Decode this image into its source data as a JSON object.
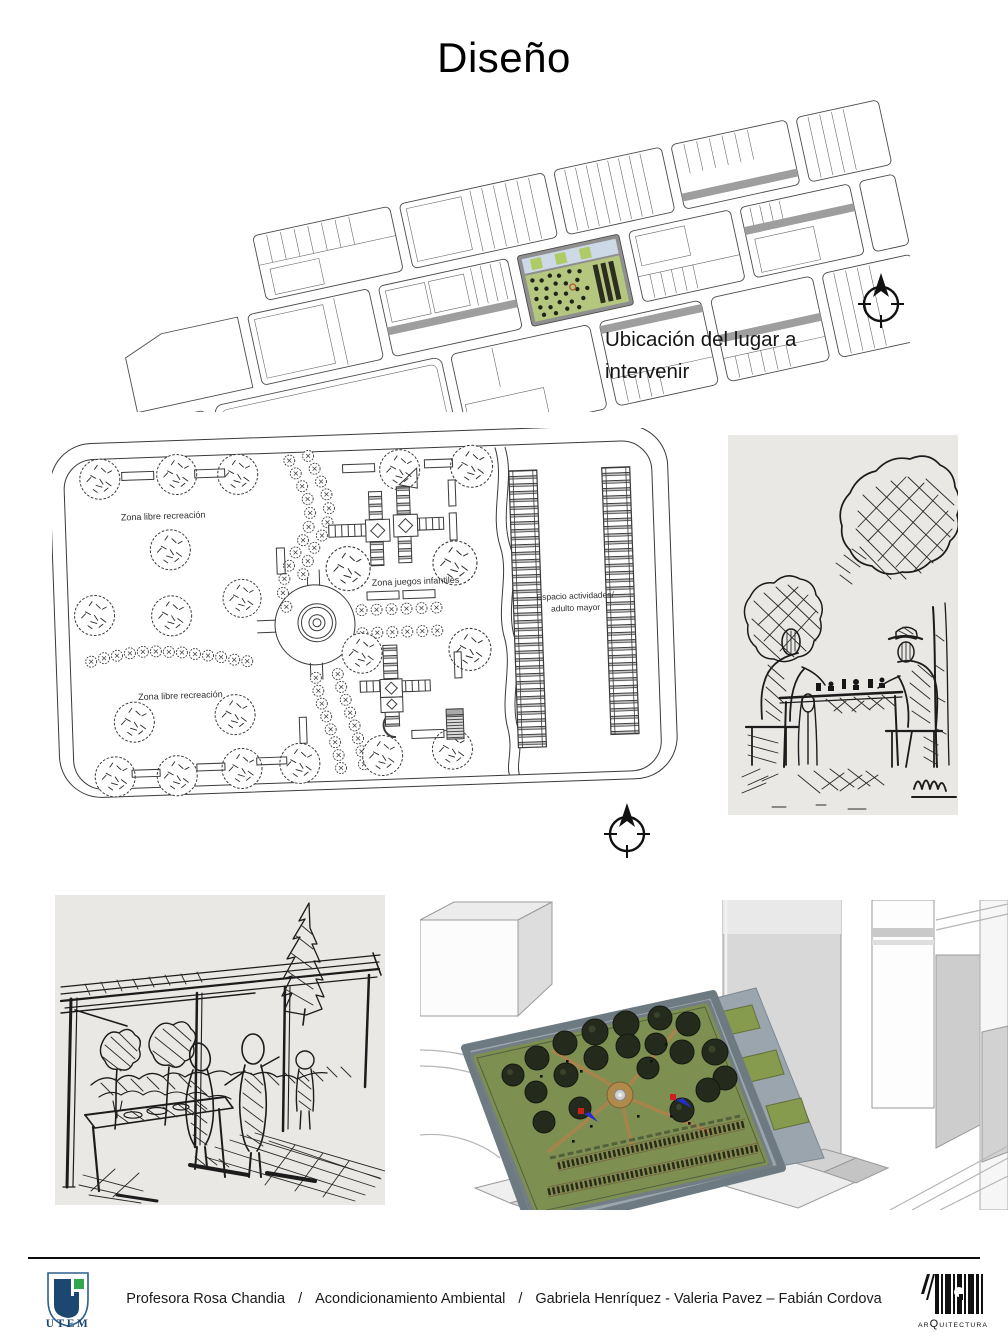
{
  "slide": {
    "title": "Diseño"
  },
  "location_note": "Ubicación del lugar a intervenir",
  "plan_labels": {
    "zona_libre_top": "Zona libre recreación",
    "zona_juegos": "Zona juegos infantiles",
    "espacio_1": "Espacio actividades/",
    "espacio_2": "adulto mayor",
    "zona_libre_bottom": "Zona libre recreación"
  },
  "footer": {
    "credit_parts": [
      "Profesora Rosa Chandia",
      "/",
      "Acondicionamiento Ambiental",
      "/",
      "Gabriela Henríquez - Valeria Pavez – Fabián Cordova"
    ],
    "utem": "UTEM",
    "arq_pre": "AR",
    "arq_q": "Q",
    "arq_post": "UITECTURA"
  },
  "colors": {
    "site_green": "#b5c77f",
    "site_blue_strip": "#cdd9e6",
    "render_grass": "#7d9052",
    "render_pavement": "#9aa5ad",
    "render_tree": "#252b1c",
    "render_path": "#b08a4a",
    "utem_navy": "#1b4771",
    "utem_green": "#2fa84f"
  }
}
